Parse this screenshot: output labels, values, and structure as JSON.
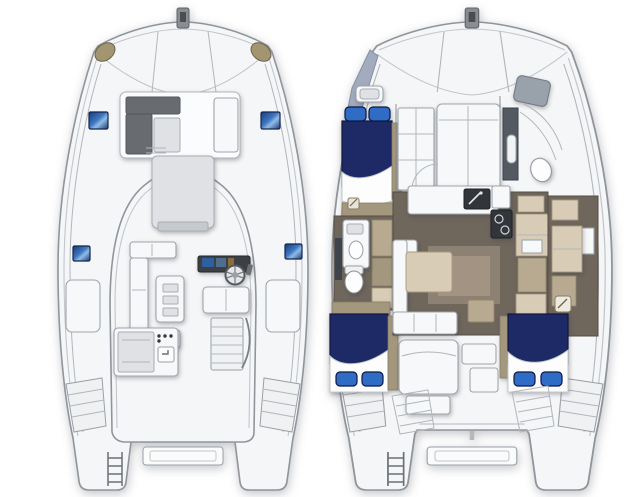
{
  "page": {
    "kind": "catamaran-floorplan-rendering",
    "views": {
      "deck_plan": {
        "id": "deck-plan",
        "features": [
          "bow-anchor-fitting",
          "trampoline",
          "mooring-winch-pods",
          "foredeck-lounge",
          "deck-hatches",
          "flybridge",
          "sunpad",
          "l-settee",
          "cockpit-table",
          "helm-console",
          "steering-wheel",
          "helm-seat",
          "wet-bar-grill",
          "flybridge-stairs",
          "side-lockers",
          "transom-steps",
          "boarding-ladder",
          "swim-platform"
        ]
      },
      "interior_plan": {
        "id": "interior-plan",
        "features": [
          "port-forward-berth",
          "port-head",
          "port-aft-berth",
          "forward-stateroom",
          "starboard-forward-head",
          "salon-sofa",
          "salon-table",
          "galley-sink",
          "galley-stove",
          "galley-cabinets",
          "starboard-cabin-storage",
          "starboard-aft-berth",
          "aft-sunbed",
          "cockpit-stairs",
          "transom-steps",
          "boarding-ladder",
          "swim-platform"
        ]
      }
    }
  },
  "colors": {
    "page_bg": "#ffffff",
    "hull_fill": "#f5f6f7",
    "hull_line": "#8f959b",
    "deck_line": "#c2c6ca",
    "white_furn": "#f7f8f9",
    "gray_furn": "#dfe1e4",
    "dark_block": "#686c71",
    "navy": "#1e2a66",
    "navy_dark": "#0f1840",
    "pillow": "#2f6cc6",
    "tan_pod": "#a2956f",
    "wedge": "#a3abbe",
    "floor": "#6f665c",
    "floor_light": "#8d8174",
    "rug": "#a29382",
    "beige": "#d8ccb7",
    "beige_dark": "#b7aa90",
    "tan": "#a3977d",
    "console": "#3c4044",
    "appliance": "#32363b",
    "cabinet_gray": "#99a1aa",
    "steel": "#545a62"
  }
}
